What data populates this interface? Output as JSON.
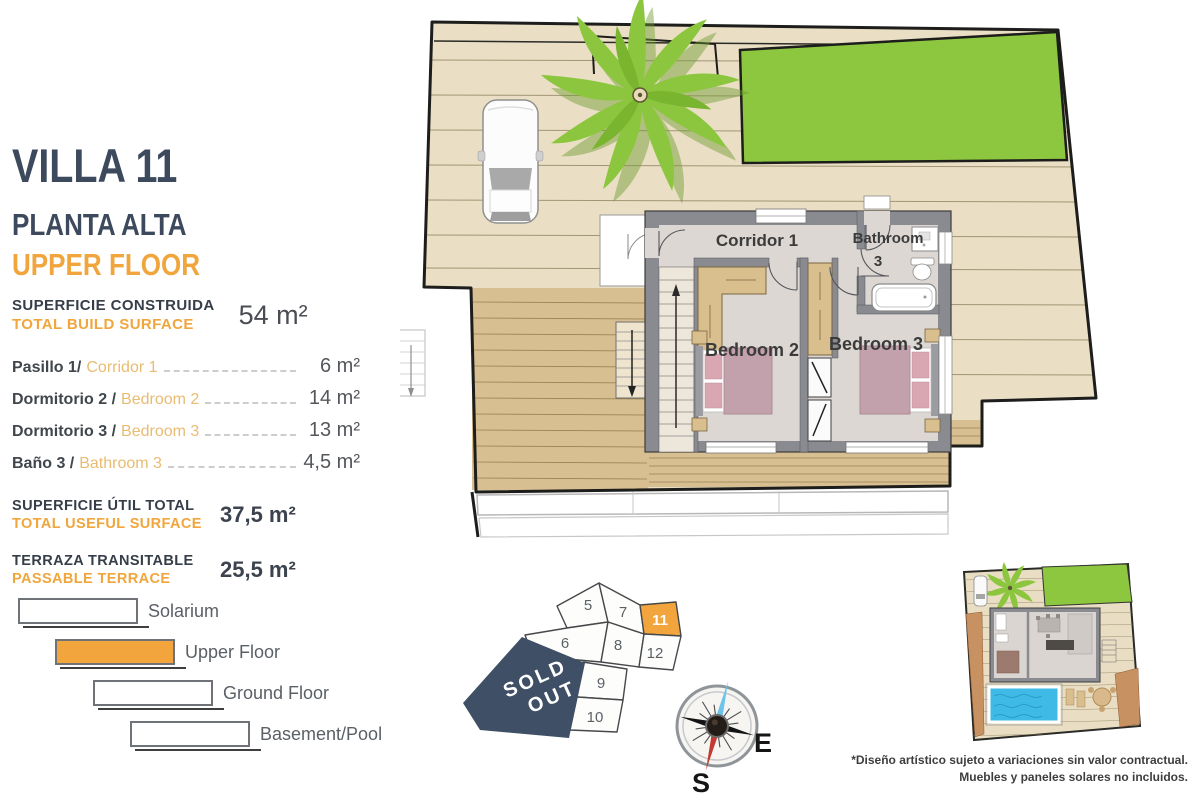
{
  "panel": {
    "title": "VILLA 11",
    "subtitle_es": "PLANTA ALTA",
    "subtitle_en": "UPPER FLOOR",
    "build_surface_label_es": "SUPERFICIE CONSTRUIDA",
    "build_surface_label_en": "TOTAL BUILD SURFACE",
    "build_surface_value": "54 m²",
    "rooms": [
      {
        "name_es": "Pasillo 1/",
        "name_en": "Corridor 1",
        "value": "6 m²"
      },
      {
        "name_es": "Dormitorio 2 /",
        "name_en": "Bedroom 2",
        "value": "14 m²"
      },
      {
        "name_es": "Dormitorio 3 /",
        "name_en": "Bedroom 3",
        "value": "13 m²"
      },
      {
        "name_es": "Baño 3 /",
        "name_en": "Bathroom 3",
        "value": "4,5 m²"
      }
    ],
    "useful_label_es": "SUPERFICIE ÚTIL TOTAL",
    "useful_label_en": "TOTAL USEFUL SURFACE",
    "useful_value": "37,5 m²",
    "terrace_label_es": "TERRAZA TRANSITABLE",
    "terrace_label_en": "PASSABLE TERRACE",
    "terrace_value": "25,5 m²"
  },
  "legend": {
    "items": [
      {
        "label": "Solarium"
      },
      {
        "label": "Upper Floor"
      },
      {
        "label": "Ground Floor"
      },
      {
        "label": "Basement/Pool"
      }
    ]
  },
  "floorplan": {
    "corridor": "Corridor 1",
    "bathroom_word": "Bathroom",
    "bathroom_number": "3",
    "bedroom2": "Bedroom 2",
    "bedroom3": "Bedroom 3"
  },
  "plot_map": {
    "lots": [
      "5",
      "7",
      "11",
      "6",
      "8",
      "12",
      "9",
      "10"
    ],
    "highlighted_lot": "11",
    "sold_line1": "SOLD",
    "sold_line2": "OUT"
  },
  "compass": {
    "east": "E",
    "south": "S"
  },
  "footer": {
    "line1": "*Diseño artístico sujeto a variaciones sin valor contractual.",
    "line2": "Muebles y paneles solares no incluidos."
  },
  "colors": {
    "accent_orange": "#F0A63C",
    "heading_navy": "#3D4A5D",
    "sold_out_navy": "#3E4F66",
    "lawn_green": "#8DC63F",
    "deck_light": "#EADFC4",
    "terrace_tan": "#D8BF92",
    "wall_gray": "#8A8A91",
    "bed_mauve": "#C2A0AC",
    "pool_blue": "#3FB9E6"
  }
}
